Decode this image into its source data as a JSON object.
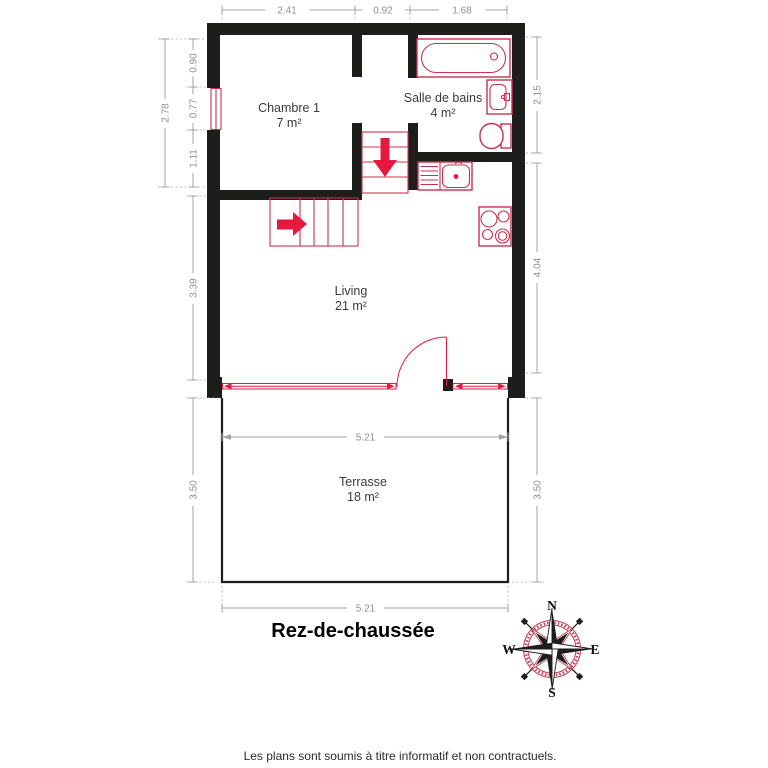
{
  "plan": {
    "title": "Rez-de-chaussée",
    "disclaimer": "Les plans sont soumis à titre informatif et non contractuels.",
    "rooms": [
      {
        "name": "Chambre 1",
        "area": "7 m²"
      },
      {
        "name": "Salle de bains",
        "area": "4 m²"
      },
      {
        "name": "Living",
        "area": "21 m²"
      },
      {
        "name": "Terrasse",
        "area": "18 m²"
      }
    ],
    "dimensions": {
      "top": [
        "2.41",
        "0.92",
        "1.68"
      ],
      "left_total": "2.78",
      "left_segments": [
        "0.90",
        "0.77",
        "1.11"
      ],
      "left_living": "3.39",
      "right_bath": "2.15",
      "right_living": "4.04",
      "terrace_top": "5.21",
      "terrace_bottom": "5.21",
      "terrace_left": "3.50",
      "terrace_right": "3.50"
    },
    "compass": {
      "n": "N",
      "e": "E",
      "s": "S",
      "w": "W"
    },
    "colors": {
      "wall": "#1d1d1b",
      "fixture_red": "#c8334e",
      "arrow_red": "#e8173f",
      "dimension_gray": "#a3a3a3",
      "label_gray": "#3a3a3a"
    }
  }
}
